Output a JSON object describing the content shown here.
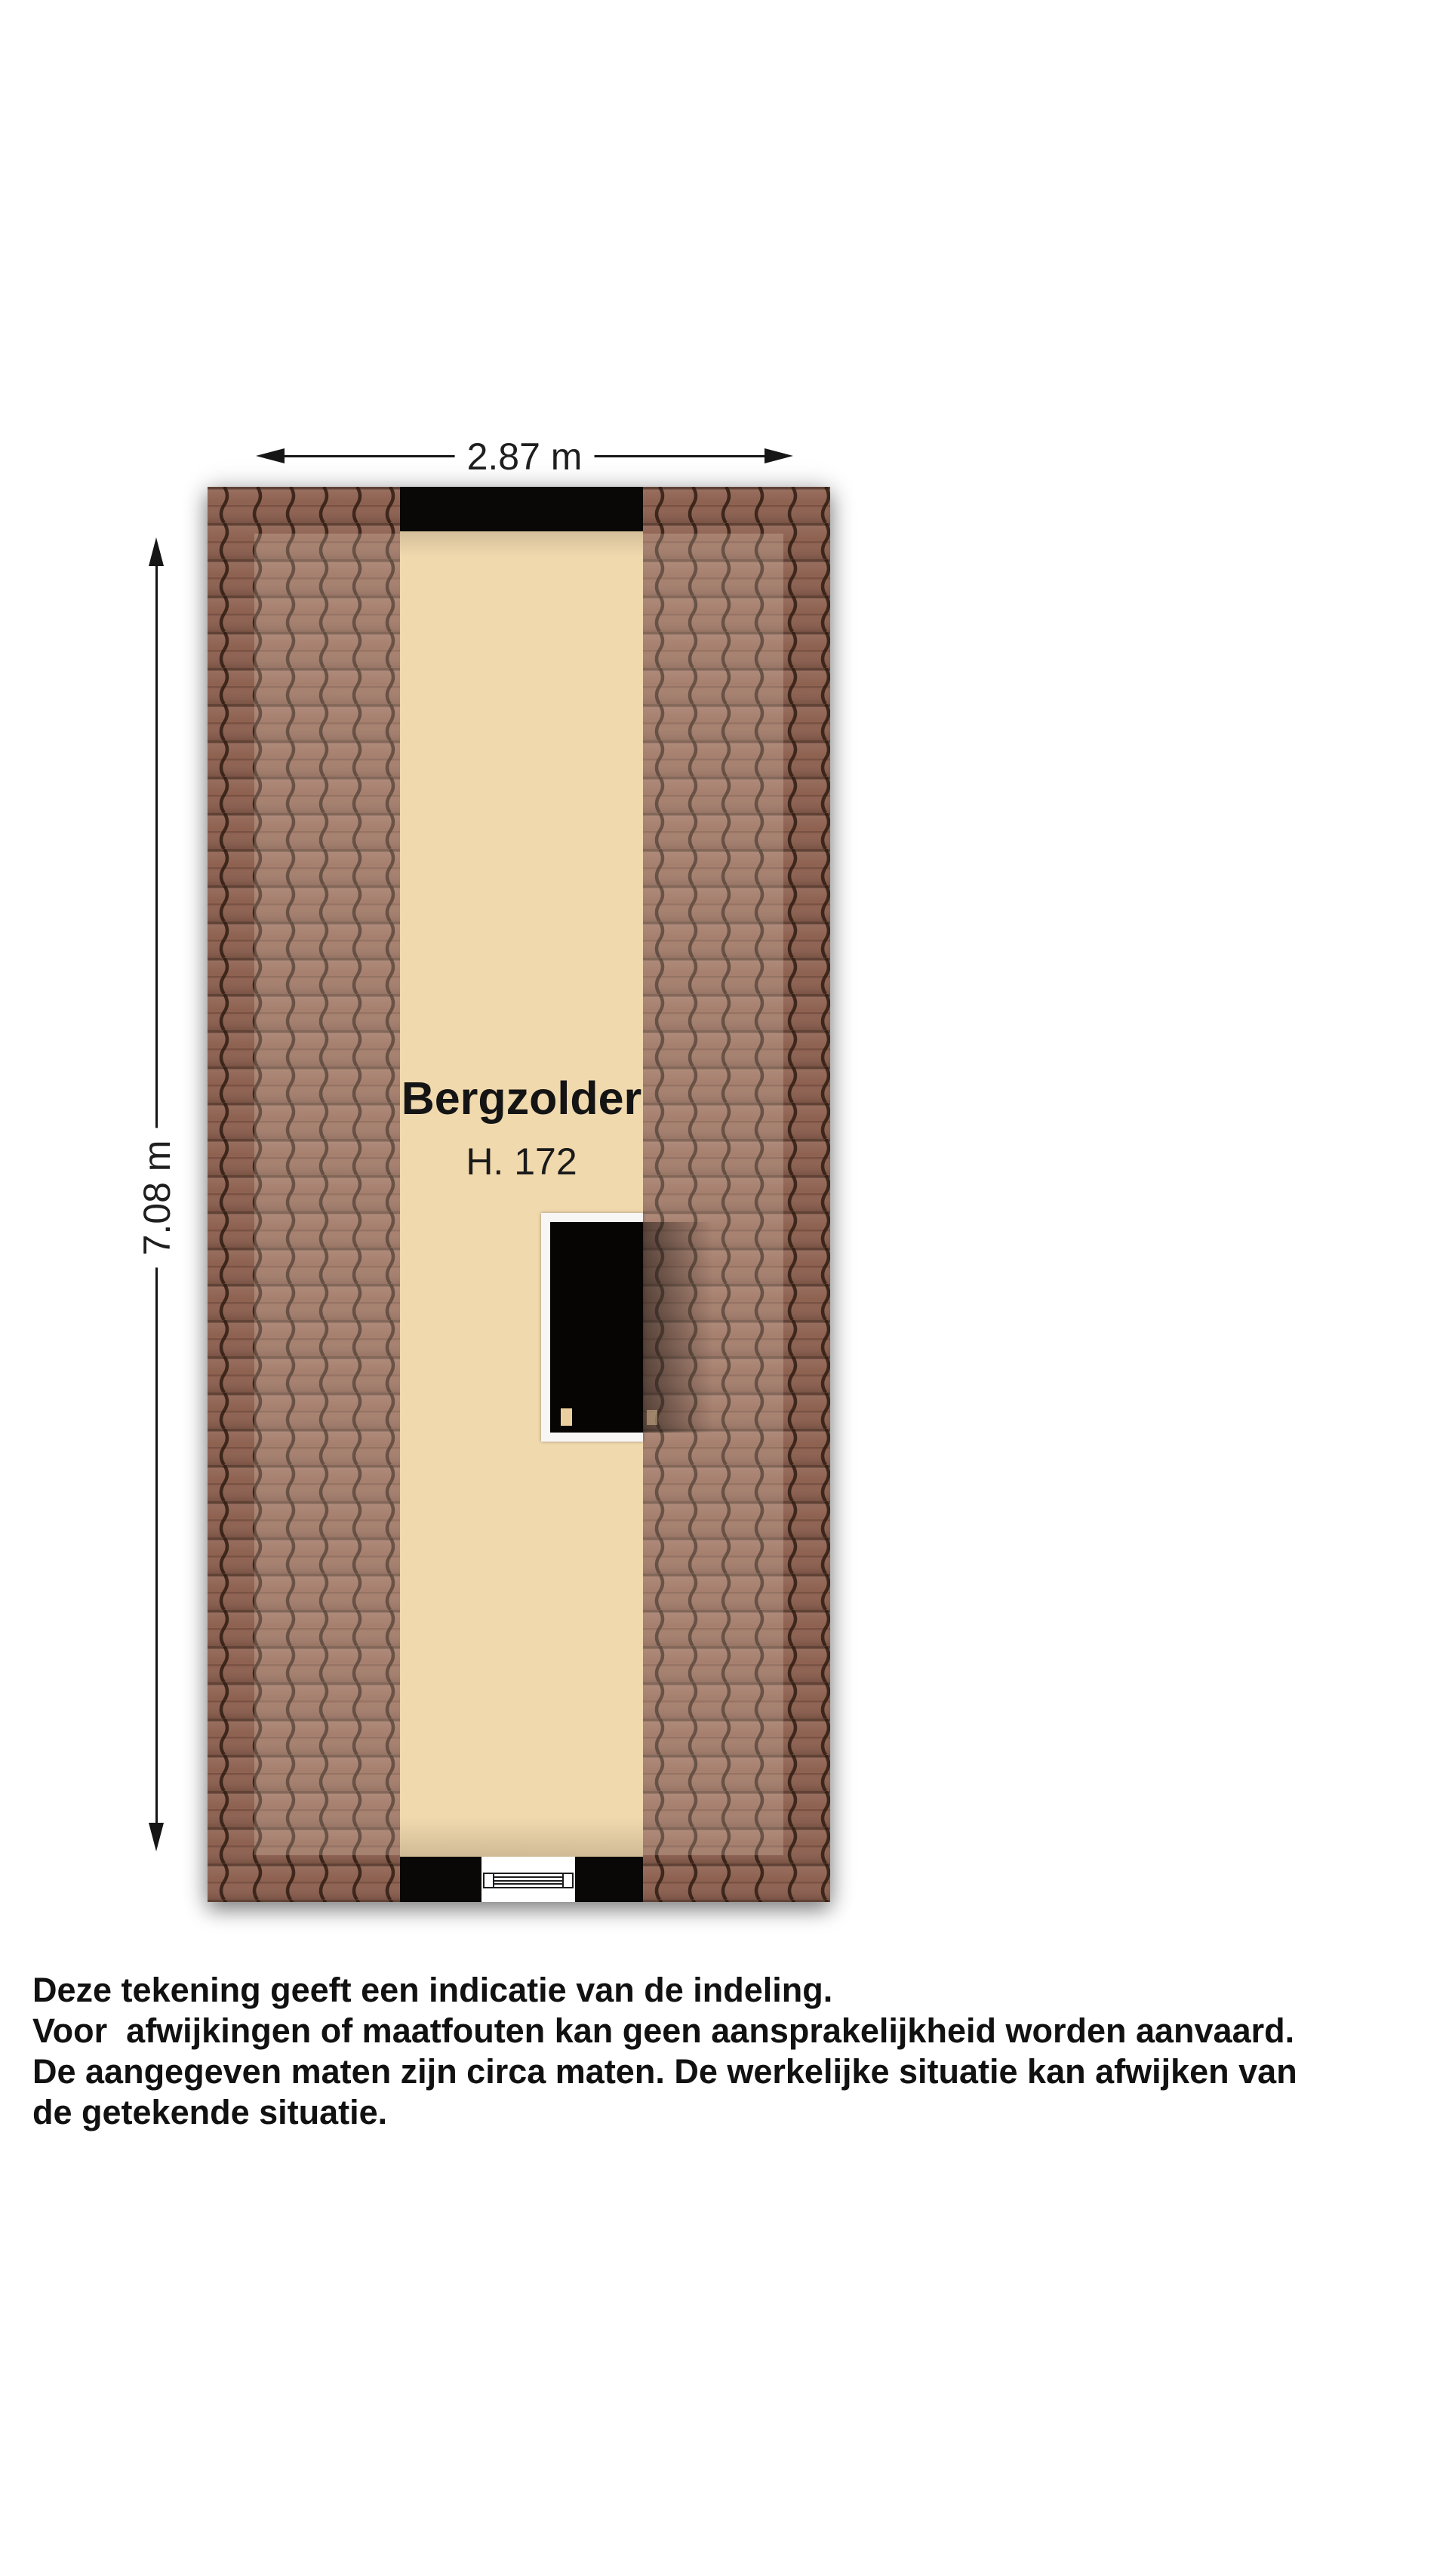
{
  "floorplan": {
    "room_label": "Bergzolder",
    "height_label": "H. 172",
    "width_dim": "2.87 m",
    "height_dim": "7.08 m"
  },
  "disclaimer": {
    "lines": [
      "Deze tekening geeft een indicatie van de indeling.",
      "Voor  afwijkingen of maatfouten kan geen aansprakelijkheid worden aanvaard.",
      "De aangegeven maten zijn circa maten. De werkelijke situatie kan afwijken van",
      "de getekende situatie."
    ]
  },
  "colors": {
    "background": "#ffffff",
    "floor_cream": "#f1d9ae",
    "roof_tile": "#8e6150",
    "roof_tile_line": "#2a180e",
    "wall_black": "#0a0806",
    "stair_frame_white": "#f7f6f4",
    "dimension_line": "#161616",
    "text": "#111111"
  }
}
